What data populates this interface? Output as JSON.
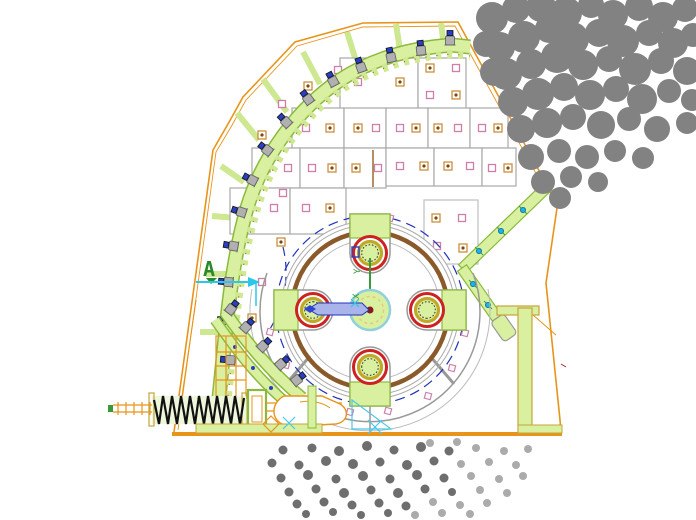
{
  "annotations": {
    "section_marker": "A",
    "axis_y_label": "Y",
    "axis_x_label": "X"
  },
  "palette": {
    "casing_orange": "#e8941a",
    "liner_green_fill": "#d9f0a0",
    "liner_green_edge": "#8aba3c",
    "rotor_brown": "#8a5a2a",
    "dashed_blue": "#2233bb",
    "hammer_ring_red": "#cc2222",
    "hammer_ring_olive": "#c0a828",
    "bolt_cap_blue": "#2a3fc0",
    "marker_pink": "#cc7fa8",
    "marker_orange": "#c8862c",
    "section_green": "#2a8a2a",
    "arrow_cyan": "#2ec8e8",
    "velocity_arrow_lavender": "#a8b4ea",
    "rock_gray": "#828282",
    "particle_dark": "#6e6e6e",
    "particle_light": "#ababab",
    "panel_line_gray": "#a8a8a8"
  }
}
